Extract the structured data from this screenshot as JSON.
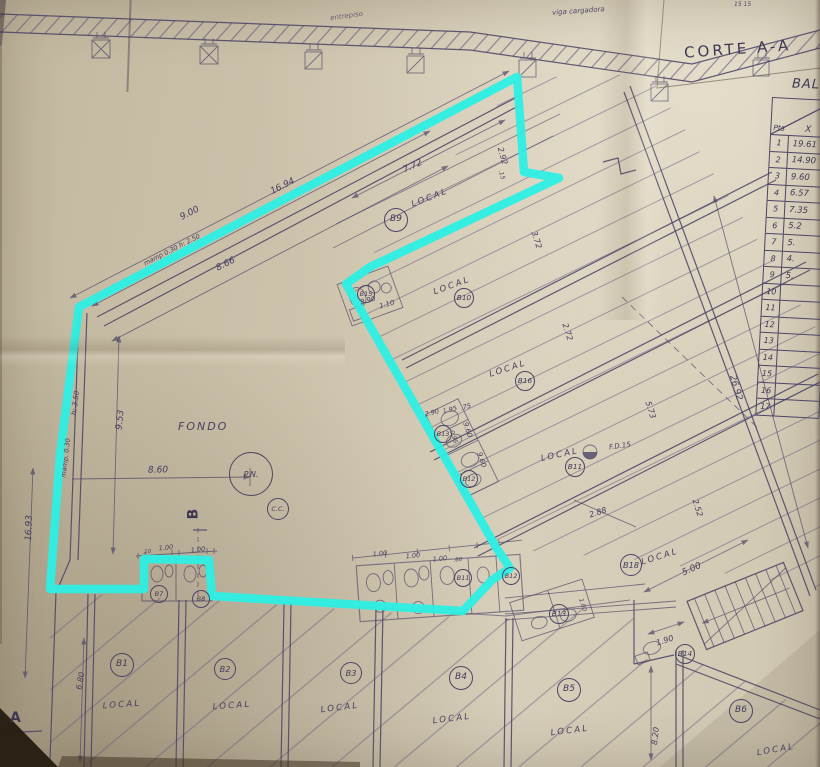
{
  "colors": {
    "highlight": "#2cefe4",
    "ink": "#4c4566",
    "paper": "#cdc4ae"
  },
  "corte": {
    "title": "CORTE A-A",
    "note_left": "entrepiso",
    "note_right": "viga cargadora",
    "corner_note": "15  15"
  },
  "table": {
    "title": "BAL",
    "col_pts": "Pts",
    "col_x": "X",
    "rows": [
      {
        "n": "1",
        "v": "19.61"
      },
      {
        "n": "2",
        "v": "14.90"
      },
      {
        "n": "3",
        "v": "9.60"
      },
      {
        "n": "4",
        "v": "6.57"
      },
      {
        "n": "5",
        "v": "7.35"
      },
      {
        "n": "6",
        "v": "5.2"
      },
      {
        "n": "7",
        "v": "5."
      },
      {
        "n": "8",
        "v": "4."
      },
      {
        "n": "9",
        "v": "5."
      },
      {
        "n": "10",
        "v": ""
      },
      {
        "n": "11",
        "v": ""
      },
      {
        "n": "12",
        "v": ""
      },
      {
        "n": "13",
        "v": ""
      },
      {
        "n": "14",
        "v": ""
      },
      {
        "n": "15",
        "v": ""
      },
      {
        "n": "16",
        "v": ""
      },
      {
        "n": "17",
        "v": ""
      }
    ]
  },
  "plan": {
    "area_label": "FONDO",
    "local_label": "LOCAL",
    "pn_label": "P.N.",
    "cc_label": "C.C.",
    "fd_label": "F.D.15",
    "section_a": "A",
    "section_b": "B",
    "units": [
      {
        "t": "B9",
        "x": 395,
        "y": 219,
        "r": 11
      },
      {
        "t": "B10",
        "x": 463,
        "y": 297,
        "r": 9
      },
      {
        "t": "B16",
        "x": 524,
        "y": 380,
        "r": 9
      },
      {
        "t": "B11",
        "x": 574,
        "y": 466,
        "r": 9
      },
      {
        "t": "B18",
        "x": 630,
        "y": 564,
        "r": 10
      },
      {
        "t": "B15",
        "x": 365,
        "y": 293,
        "r": 8
      },
      {
        "t": "B13",
        "x": 442,
        "y": 433,
        "r": 8
      },
      {
        "t": "B12",
        "x": 468,
        "y": 478,
        "r": 8
      },
      {
        "t": "B7",
        "x": 158,
        "y": 593,
        "r": 8
      },
      {
        "t": "B8",
        "x": 200,
        "y": 598,
        "r": 8
      },
      {
        "t": "B11",
        "x": 462,
        "y": 577,
        "r": 8
      },
      {
        "t": "B12",
        "x": 510,
        "y": 575,
        "r": 8
      },
      {
        "t": "B13",
        "x": 558,
        "y": 613,
        "r": 9
      },
      {
        "t": "B14",
        "x": 684,
        "y": 653,
        "r": 9
      },
      {
        "t": "B1",
        "x": 121,
        "y": 664,
        "r": 11
      },
      {
        "t": "B2",
        "x": 224,
        "y": 668,
        "r": 10
      },
      {
        "t": "B3",
        "x": 350,
        "y": 672,
        "r": 10
      },
      {
        "t": "B4",
        "x": 460,
        "y": 677,
        "r": 11
      },
      {
        "t": "B5",
        "x": 568,
        "y": 689,
        "r": 11
      },
      {
        "t": "B6",
        "x": 740,
        "y": 710,
        "r": 11
      }
    ],
    "locals": [
      {
        "x": 430,
        "y": 198,
        "rot": -21
      },
      {
        "x": 452,
        "y": 286,
        "rot": -20
      },
      {
        "x": 508,
        "y": 369,
        "rot": -18
      },
      {
        "x": 560,
        "y": 455,
        "rot": -12
      },
      {
        "x": 660,
        "y": 557,
        "rot": -17
      },
      {
        "x": 122,
        "y": 705,
        "rot": -4
      },
      {
        "x": 232,
        "y": 706,
        "rot": -4
      },
      {
        "x": 340,
        "y": 708,
        "rot": -7
      },
      {
        "x": 452,
        "y": 719,
        "rot": -7
      },
      {
        "x": 570,
        "y": 731,
        "rot": -7
      },
      {
        "x": 776,
        "y": 750,
        "rot": -10
      }
    ],
    "dims": [
      {
        "t": "16.94",
        "x": 283,
        "y": 187,
        "rot": -27,
        "s": 9
      },
      {
        "t": "9.00",
        "x": 190,
        "y": 214,
        "rot": -27,
        "s": 9
      },
      {
        "t": "mamp 0.30   h: 2.50",
        "x": 172,
        "y": 250,
        "rot": -27,
        "s": 6.5
      },
      {
        "t": "8.66",
        "x": 226,
        "y": 265,
        "rot": -27,
        "s": 9
      },
      {
        "t": "7.72",
        "x": 413,
        "y": 167,
        "rot": -24,
        "s": 9
      },
      {
        "t": "2.92",
        "x": 502,
        "y": 156,
        "rot": 74,
        "s": 8
      },
      {
        "t": ".15",
        "x": 501,
        "y": 175,
        "rot": 74,
        "s": 6
      },
      {
        "t": "3.72",
        "x": 536,
        "y": 240,
        "rot": 72,
        "s": 8
      },
      {
        "t": "2.72",
        "x": 567,
        "y": 332,
        "rot": 72,
        "s": 8
      },
      {
        "t": "5.73",
        "x": 650,
        "y": 410,
        "rot": 72,
        "s": 8
      },
      {
        "t": "26.92",
        "x": 735,
        "y": 388,
        "rot": 74,
        "s": 9
      },
      {
        "t": "2.52",
        "x": 697,
        "y": 508,
        "rot": 73,
        "s": 8
      },
      {
        "t": "2.88",
        "x": 598,
        "y": 513,
        "rot": -18,
        "s": 8
      },
      {
        "t": "9.53",
        "x": 121,
        "y": 420,
        "rot": -84,
        "s": 9
      },
      {
        "t": "h: 3.50",
        "x": 76,
        "y": 403,
        "rot": -83,
        "s": 7
      },
      {
        "t": "mamp. 0.30",
        "x": 66,
        "y": 458,
        "rot": -83,
        "s": 6.5
      },
      {
        "t": "16.93",
        "x": 30,
        "y": 528,
        "rot": -88,
        "s": 9
      },
      {
        "t": "8.60",
        "x": 158,
        "y": 471,
        "rot": -1,
        "s": 9
      },
      {
        "t": "6.80",
        "x": 81,
        "y": 681,
        "rot": -80,
        "s": 8
      },
      {
        "t": "2.90",
        "x": 368,
        "y": 301,
        "rot": -15,
        "s": 7
      },
      {
        "t": "1.10",
        "x": 387,
        "y": 305,
        "rot": -15,
        "s": 7
      },
      {
        "t": "2.90",
        "x": 432,
        "y": 413,
        "rot": -14,
        "s": 6.5
      },
      {
        "t": "1.95",
        "x": 450,
        "y": 410,
        "rot": -14,
        "s": 6.5
      },
      {
        "t": ".75",
        "x": 466,
        "y": 407,
        "rot": -14,
        "s": 6.5
      },
      {
        "t": "9.60",
        "x": 467,
        "y": 430,
        "rot": 72,
        "s": 7
      },
      {
        "t": "9.60",
        "x": 481,
        "y": 460,
        "rot": 72,
        "s": 7
      },
      {
        "t": "0.95",
        "x": 453,
        "y": 437,
        "rot": 72,
        "s": 6
      },
      {
        "t": "1.00",
        "x": 166,
        "y": 548,
        "rot": -6,
        "s": 6.5
      },
      {
        "t": "1.00",
        "x": 198,
        "y": 550,
        "rot": -6,
        "s": 6.5
      },
      {
        "t": ".10",
        "x": 147,
        "y": 553,
        "rot": -6,
        "s": 5.5
      },
      {
        "t": "1.00",
        "x": 380,
        "y": 554,
        "rot": -6,
        "s": 6.5
      },
      {
        "t": "1.00",
        "x": 413,
        "y": 556,
        "rot": -6,
        "s": 6.5
      },
      {
        "t": "1.00",
        "x": 440,
        "y": 559,
        "rot": -6,
        "s": 6.5
      },
      {
        "t": ".60",
        "x": 458,
        "y": 561,
        "rot": -6,
        "s": 5.5
      },
      {
        "t": "5.00",
        "x": 692,
        "y": 570,
        "rot": -24,
        "s": 9
      },
      {
        "t": "1.90",
        "x": 665,
        "y": 641,
        "rot": -18,
        "s": 8
      },
      {
        "t": "8.20",
        "x": 656,
        "y": 736,
        "rot": -84,
        "s": 8
      },
      {
        "t": "1.00",
        "x": 582,
        "y": 605,
        "rot": 72,
        "s": 6
      }
    ]
  }
}
